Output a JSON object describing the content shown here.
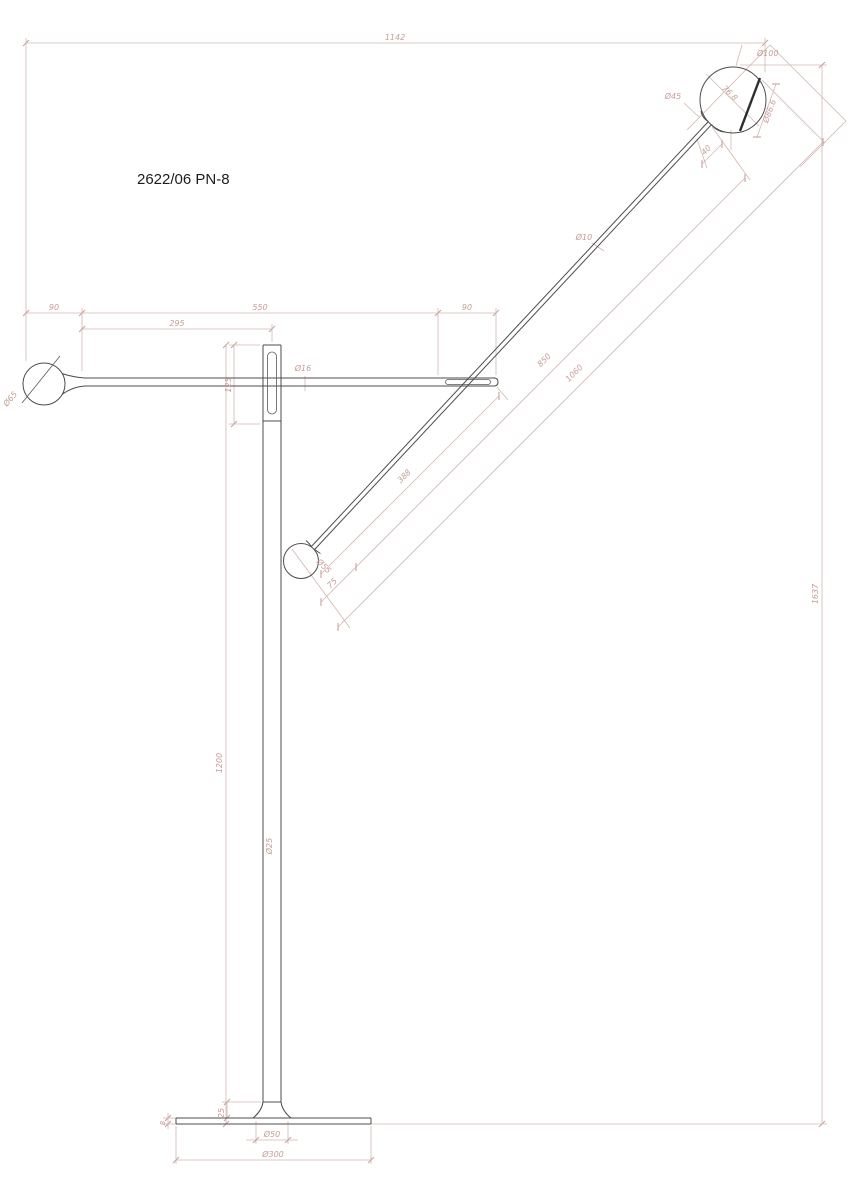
{
  "drawing": {
    "title": "2622/06 PN-8",
    "dimensions": {
      "total_width": "1142",
      "total_height": "1637",
      "top_seg_left": "90",
      "top_seg_mid": "550",
      "top_seg_right": "90",
      "arm_rear": "295",
      "bracket_length": "125",
      "pole_length": "1200",
      "arm_tube_dia": "Ø16",
      "pole_dia": "Ø25",
      "rear_ball_dia": "Ø65",
      "rod_dia": "Ø10",
      "rod_upper_len": "850",
      "rod_total_len": "1060",
      "rod_lower_len": "388",
      "counterweight_dia": "Ø55",
      "counterweight_len": "75",
      "head_dia": "Ø100",
      "head_neck_dia": "Ø45",
      "head_inner_dia": "76.8",
      "head_face_dia": "Ø86.6",
      "head_neck_len": "40",
      "base_hub_height": "25",
      "base_plate_thickness": "8",
      "base_hub_dia": "Ø50",
      "base_plate_dia": "Ø300"
    }
  }
}
